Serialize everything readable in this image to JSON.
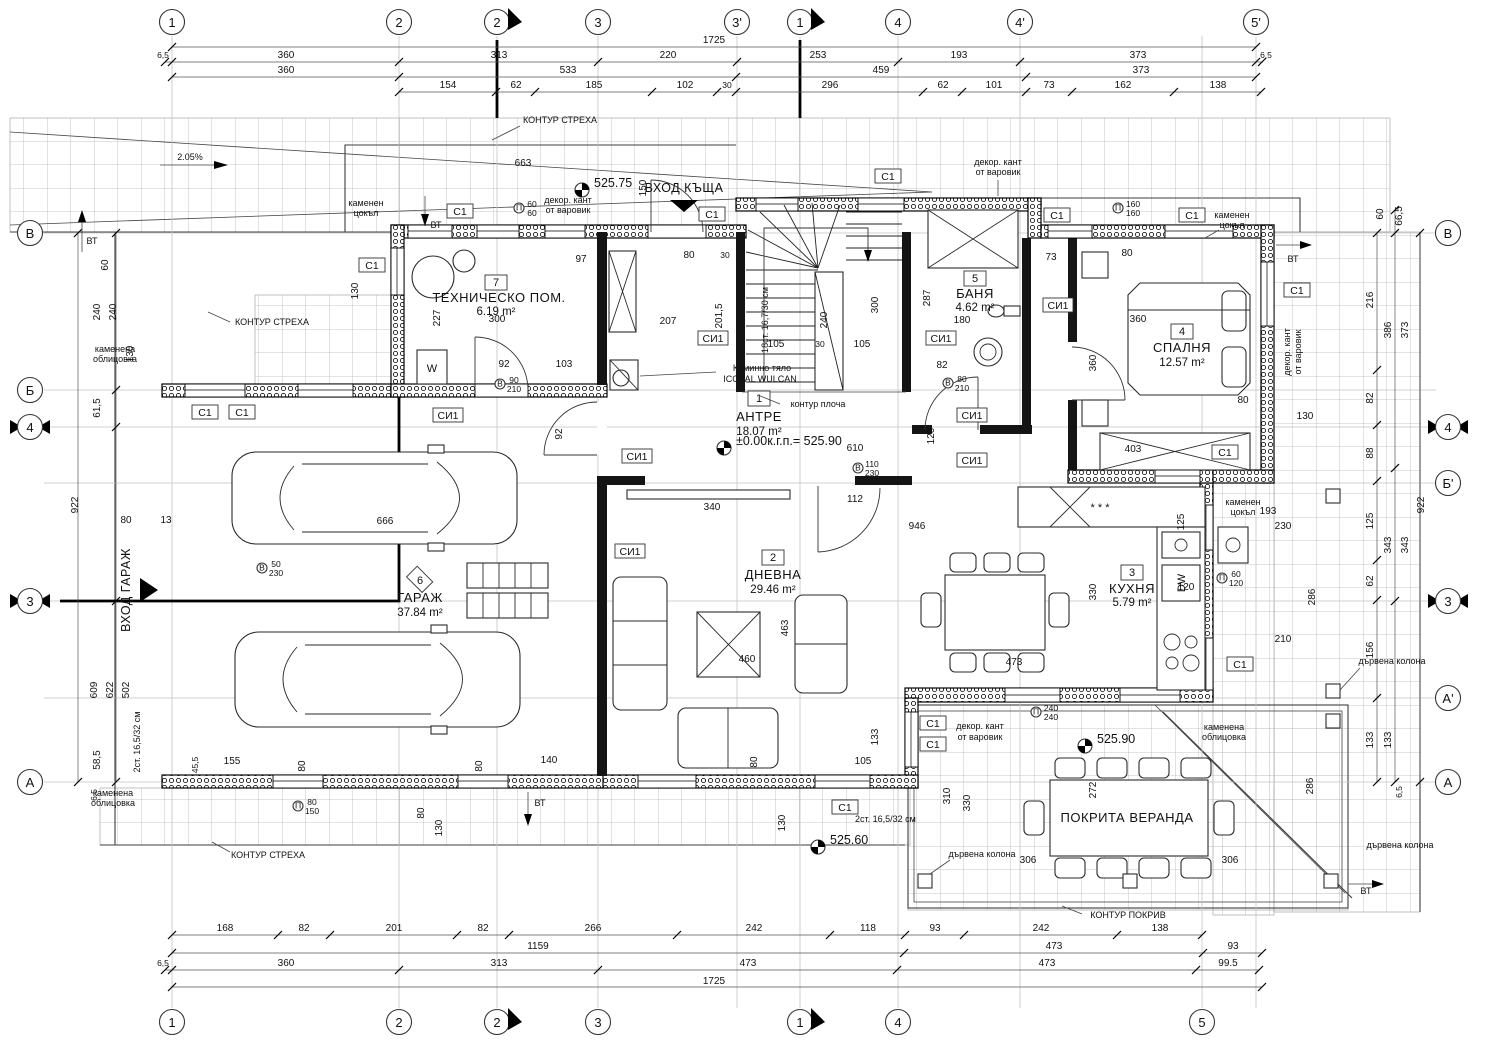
{
  "grid": {
    "top": [
      "1",
      "2",
      "2",
      "3",
      "3'",
      "1",
      "4",
      "4'",
      "5'"
    ],
    "bottom": [
      "1",
      "2",
      "2",
      "3",
      "1",
      "4",
      "5"
    ],
    "left": [
      "В",
      "Б",
      "4",
      "3",
      "А"
    ],
    "right": [
      "В",
      "4",
      "Б'",
      "3",
      "А'",
      "А"
    ]
  },
  "rooms": {
    "r1": {
      "no": "1",
      "name": "АНТРЕ",
      "area": "18.07 m²"
    },
    "r2": {
      "no": "2",
      "name": "ДНЕВНА",
      "area": "29.46 m²"
    },
    "r3": {
      "no": "3",
      "name": "КУХНЯ",
      "area": "5.79 m²"
    },
    "r4": {
      "no": "4",
      "name": "СПАЛНЯ",
      "area": "12.57 m²"
    },
    "r5": {
      "no": "5",
      "name": "БАНЯ",
      "area": "4.62 m²"
    },
    "r6": {
      "no": "6",
      "name": "ГАРАЖ",
      "area": "37.84 m²"
    },
    "r7": {
      "no": "7",
      "name": "ТЕХНИЧЕСКО ПОМ.",
      "area": "6.19 m²"
    },
    "veranda": {
      "name": "ПОКРИТА ВЕРАНДА"
    }
  },
  "levels": {
    "entry": "525.75",
    "floor": "±0.00к.г.п.= 525.90",
    "veranda": "525.90",
    "terrace": "525.60"
  },
  "entries": {
    "house": "ВХОД КЪЩА",
    "garage": "ВХОД ГАРАЖ"
  },
  "stairs": {
    "main": "18ст. 16,7/30 см",
    "ext": "2ст. 16,5/32 см",
    "slope": "2.05%",
    "flight": "240",
    "slab": "контур плоча"
  },
  "chimney": {
    "l1": "Коминно тяло",
    "l2": "ICOPAL WULCAN"
  },
  "tags": {
    "c1": "С1",
    "si1": "СИ1",
    "vt": "ВТ",
    "dw": "DW",
    "w": "W",
    "snow": "* * *",
    "b": "В",
    "p": "П"
  },
  "ann": {
    "kontur_streha": "КОНТУР СТРЕХА",
    "kontur_pokriv": "КОНТУР ПОКРИВ",
    "kamenen1": "каменен",
    "kamenen2": "цокъл",
    "oblic1": "каменена",
    "oblic2": "облицовка",
    "dekor1": "декор. кант",
    "dekor2": "от варовик",
    "kolona": "дървена колона"
  },
  "dims": {
    "top1": [
      "1725"
    ],
    "top2": [
      "6,5",
      "360",
      "313",
      "220",
      "253",
      "193",
      "373",
      "6,5"
    ],
    "top3": [
      "360",
      "533",
      "459",
      "373"
    ],
    "top4": [
      "154",
      "62",
      "185",
      "102",
      "30",
      "296",
      "62",
      "101",
      "73",
      "162",
      "138"
    ],
    "bot1": [
      "168",
      "82",
      "201",
      "82",
      "266",
      "242",
      "118",
      "93",
      "242",
      "138"
    ],
    "bot2": [
      "1159",
      "473",
      "93"
    ],
    "bot3": [
      "6,5",
      "360",
      "313",
      "473",
      "473",
      "99.5"
    ],
    "bot4": [
      "1725"
    ],
    "left": [
      "60",
      "240",
      "240",
      "130",
      "61,5",
      "922",
      "609",
      "622",
      "502",
      "58,5",
      "80",
      "13",
      "6,5"
    ],
    "right": [
      "60",
      "66,5",
      "216",
      "386",
      "373",
      "82",
      "88",
      "125",
      "62",
      "343",
      "343",
      "156",
      "133",
      "133",
      "922",
      "6,5"
    ],
    "inner": [
      "663",
      "150",
      "102",
      "30",
      "97",
      "207",
      "201,5",
      "227",
      "300",
      "92",
      "103",
      "240",
      "300",
      "105",
      "30",
      "105",
      "287",
      "180",
      "82",
      "73",
      "360",
      "360",
      "403",
      "80",
      "130",
      "610",
      "340",
      "112",
      "946",
      "463",
      "460",
      "80",
      "133",
      "105",
      "330",
      "125",
      "120",
      "230",
      "193",
      "286",
      "210",
      "473",
      "155",
      "45,5",
      "80",
      "140",
      "80",
      "130",
      "666",
      "310",
      "330",
      "272",
      "286",
      "306",
      "306",
      "130",
      "80",
      "92",
      "120",
      "130",
      "80",
      "102"
    ],
    "pairs": [
      [
        "90",
        "210"
      ],
      [
        "80",
        "210"
      ],
      [
        "110",
        "230"
      ],
      [
        "240",
        "240"
      ],
      [
        "60",
        "60"
      ],
      [
        "160",
        "160"
      ],
      [
        "80",
        "150"
      ],
      [
        "50",
        "230"
      ],
      [
        "60",
        "120"
      ]
    ]
  }
}
